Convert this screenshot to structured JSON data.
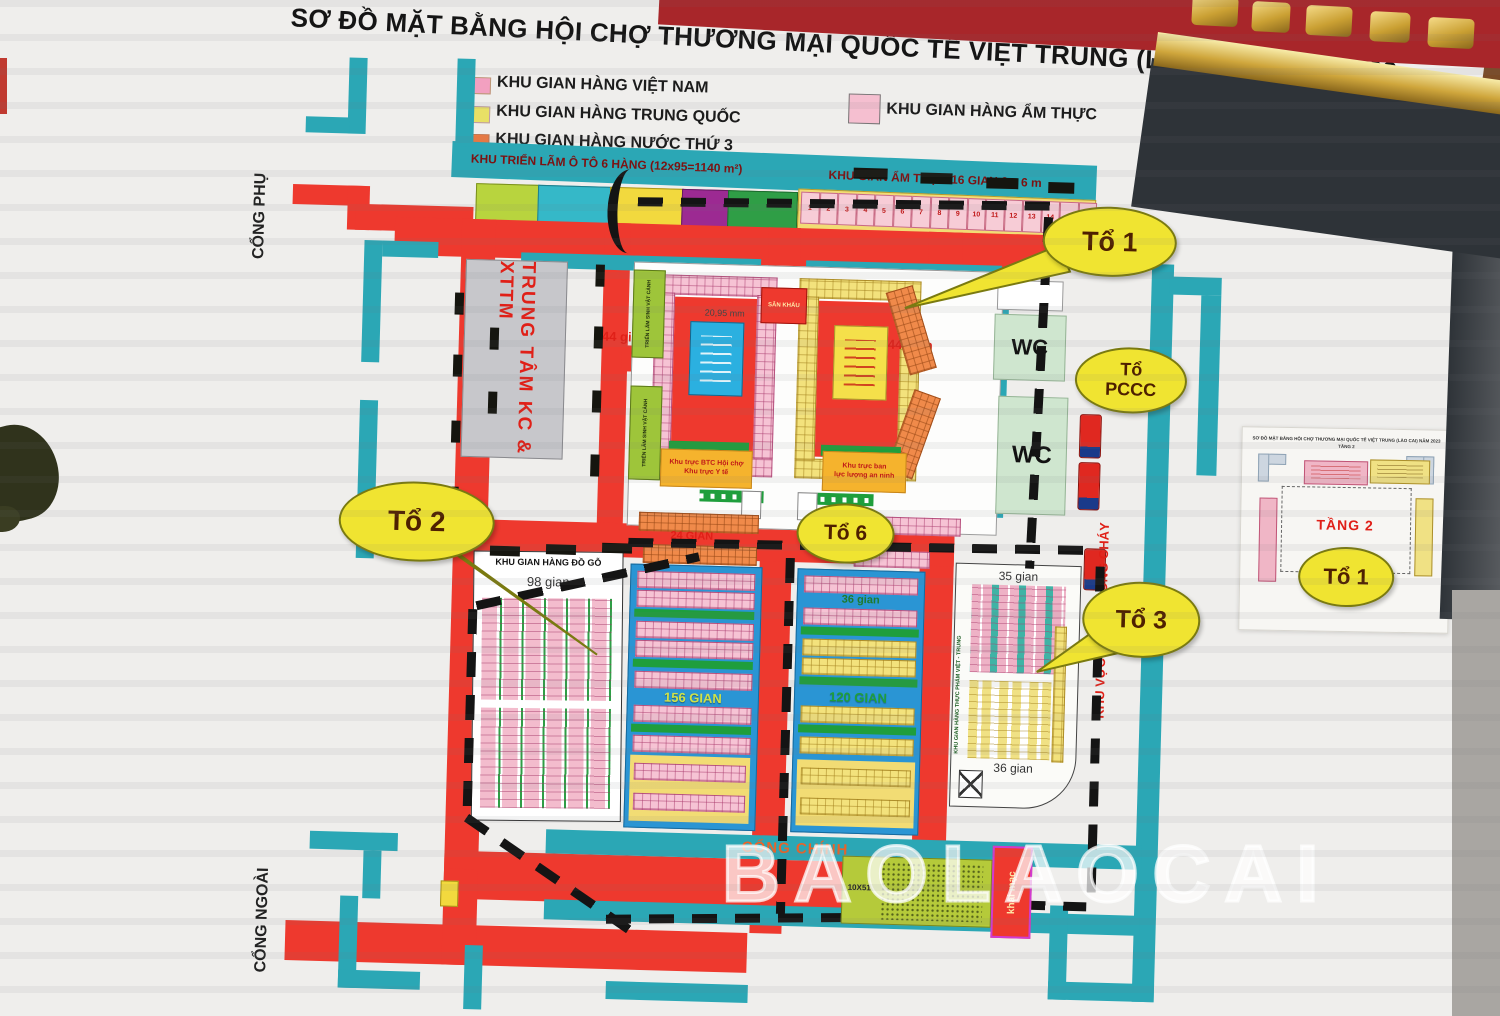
{
  "title": "SƠ ĐỒ MẶT BẰNG HỘI CHỢ THƯƠNG MẠI QUỐC TẾ VIỆT TRUNG (LÀO CAI) NĂM 2023",
  "legend": {
    "vietnam": "KHU GIAN  HÀNG VIỆT NAM",
    "china": "KHU GIAN HÀNG TRUNG QUỐC",
    "third": "KHU GIAN HÀNG NƯỚC THỨ 3",
    "food": "KHU GIAN  HÀNG ẨM THỰC"
  },
  "colors": {
    "road": "#ee392e",
    "cyan": "#2ba7b5",
    "vn_pink": "#f2a0c0",
    "cn_yellow": "#e8e066",
    "third_orange": "#f07a40",
    "food_pink": "#f5bfd0",
    "bubble": "#f0e431"
  },
  "top_strip": {
    "auto_label": "KHU TRIỂN LÃM Ô TÔ 6 HÀNG (12x95=1140 m²)",
    "food_label": "KHU GIAN ẨM THỰC 16 GIAN 6 x 6 m",
    "stalls": [
      "1",
      "2",
      "3",
      "4",
      "5",
      "6",
      "7",
      "8",
      "9",
      "10",
      "11",
      "12",
      "13",
      "14",
      "15",
      "16"
    ]
  },
  "gates": {
    "side": "CỔNG PHỤ",
    "outer": "CỔNG NGOÀI",
    "main": "CỔNG CHÍNH"
  },
  "center": {
    "kc": "TRUNG TÂM KC & XTTM",
    "stage": "SÂN KHẤU",
    "dim": "20,95 mm",
    "gian44_left": "44 gian",
    "gian44_right": "44 gian",
    "plants": "TRIỂN LÃM SINH VẬT CẢNH",
    "btc1": "Khu trực BTC Hội chợ",
    "btc2": "Khu trực Y tế",
    "sec1": "Khu trực ban",
    "sec2": "lực lượng an ninh",
    "wc": "WC",
    "fire_lane": "KHU VỰC ĐỖ XE PHÒNG CHÁY"
  },
  "blocks": {
    "wood_title": "KHU GIAN HÀNG ĐỒ GỖ",
    "wood_count": "98 gian",
    "gian24": "24 GIAN",
    "gian156": "156 GIAN",
    "gian36_top": "36 gian",
    "gian120": "120 GIAN",
    "food_v": "KHU GIAN HÀNG THỰC PHẨM VIỆT - TRUNG",
    "gian35": "35 gian",
    "gian36": "36 gian",
    "stage_dim": "10X51",
    "opening": "khai mạc"
  },
  "bubbles": {
    "to1": "Tổ 1",
    "to2": "Tổ 2",
    "to3": "Tổ 3",
    "to6": "Tổ 6",
    "pccc1": "Tổ",
    "pccc2": "PCCC",
    "inset_to1": "Tổ 1"
  },
  "inset": {
    "header": "SƠ ĐỒ MẶT BẰNG HỘI CHỢ THƯƠNG MẠI QUỐC TẾ VIỆT TRUNG (LÀO CAI) NĂM 2023",
    "header2": "TẦNG 2",
    "floor": "TẦNG 2"
  },
  "watermark": "BAOLAOCAI"
}
